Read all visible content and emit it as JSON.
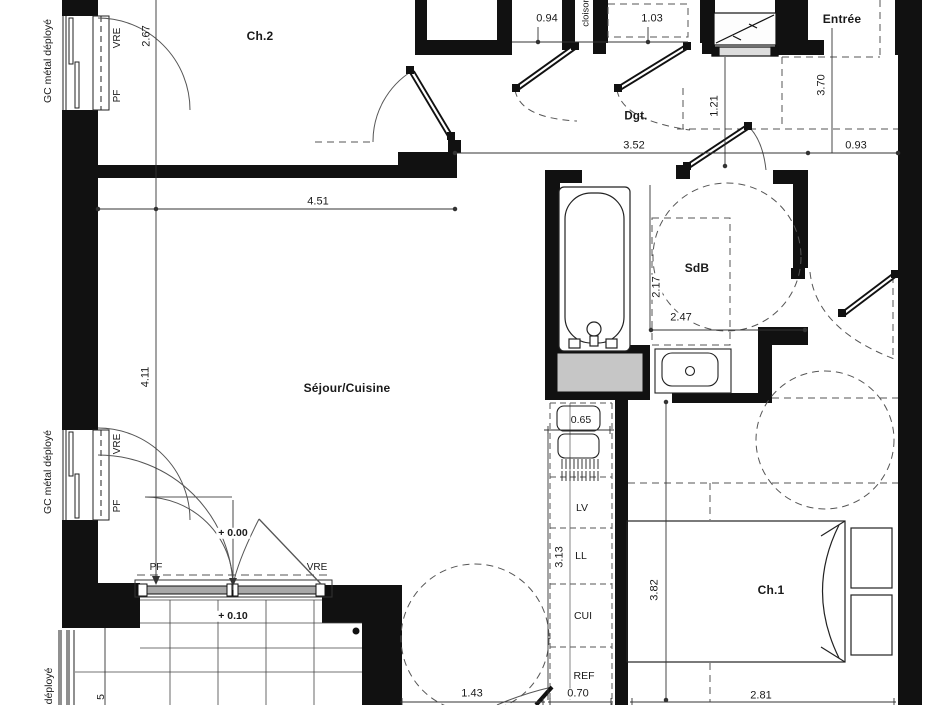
{
  "rooms": {
    "ch2": "Ch.2",
    "entree": "Entrée",
    "dgt": "Dgt.",
    "sdb": "SdB",
    "sejour": "Séjour/Cuisine",
    "ch1": "Ch.1"
  },
  "dims": {
    "ch2_depth": "2.67",
    "sejour_w": "4.51",
    "sejour_h": "4.11",
    "closet_a": "0.94",
    "closet_b": "1.03",
    "hall_w": "3.52",
    "hall_r": "0.93",
    "entree_h": "3.70",
    "entree_w": "1.21",
    "sdb_v": "2.17",
    "sdb_h": "2.47",
    "sink_w": "0.65",
    "kitchen_h": "3.13",
    "kitchen_w": "0.70",
    "ch1_h": "3.82",
    "ch1_w": "2.81",
    "sejour_bottom": "1.43",
    "balcony_part": "5"
  },
  "tags": {
    "vre": "VRE",
    "pf": "PF",
    "gc": "GC métal déployé",
    "gc_partial": "déployé",
    "cloison": "cloison",
    "lv": "LV",
    "ll": "LL",
    "cui": "CUI",
    "ref": "REF",
    "level0": "+ 0.00",
    "level10": "+ 0.10"
  },
  "colors": {
    "wall": "#111111",
    "line": "#333333",
    "dash": "#555555",
    "equip_gray": "#c6c6c6"
  }
}
